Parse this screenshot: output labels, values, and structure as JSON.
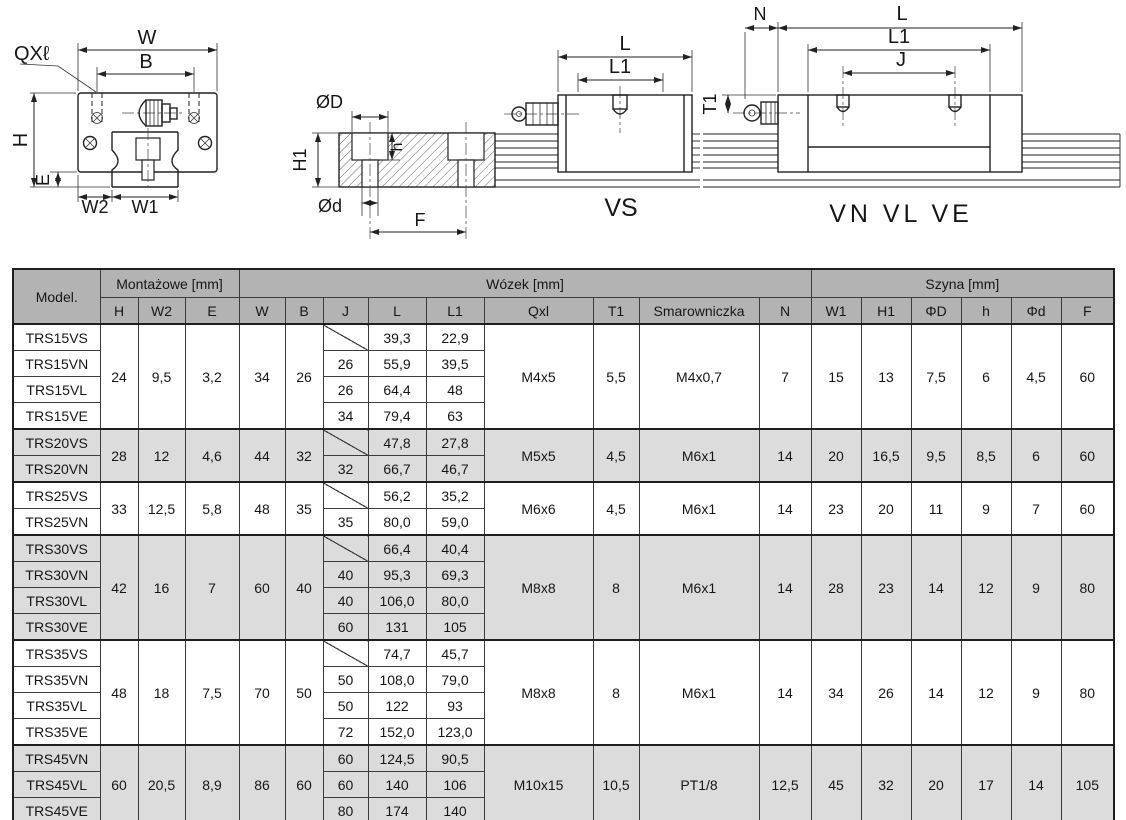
{
  "colors": {
    "header_bg": "#b3b3b3",
    "shaded_row_bg": "#dcdcdc",
    "border": "#3c3c3c",
    "text": "#161616"
  },
  "drawings": {
    "cross_section": {
      "qxl": "QXℓ",
      "w": "W",
      "b": "B",
      "h": "H",
      "e": "E",
      "w2": "W2",
      "w1": "W1"
    },
    "rail_section": {
      "od": "ØD",
      "h1": "H1",
      "h": "h",
      "od_small": "Ød",
      "f": "F"
    },
    "vs_view": {
      "l": "L",
      "l1": "L1",
      "caption": "VS"
    },
    "vn_view": {
      "n": "N",
      "l": "L",
      "l1": "L1",
      "j": "J",
      "t1": "T1",
      "caption": "VN VL VE"
    }
  },
  "table": {
    "corner_label": "Model.",
    "group_headers": [
      {
        "label": "Montażowe [mm]",
        "span": 3
      },
      {
        "label": "Wózek [mm]",
        "span": 9
      },
      {
        "label": "Szyna [mm]",
        "span": 6
      }
    ],
    "columns": [
      "H",
      "W2",
      "E",
      "W",
      "B",
      "J",
      "L",
      "L1",
      "Qxl",
      "T1",
      "Smarowniczka",
      "N",
      "W1",
      "H1",
      "ΦD",
      "h",
      "Φd",
      "F"
    ],
    "groups": [
      {
        "shaded": false,
        "shared": {
          "H": "24",
          "W2": "9,5",
          "E": "3,2",
          "W": "34",
          "B": "26",
          "Qxl": "M4x5",
          "T1": "5,5",
          "Smarowniczka": "M4x0,7",
          "N": "7",
          "W1": "15",
          "H1": "13",
          "ΦD": "7,5",
          "h": "6",
          "Φd": "4,5",
          "F": "60"
        },
        "rows": [
          {
            "model": "TRS15VS",
            "J": null,
            "L": "39,3",
            "L1": "22,9"
          },
          {
            "model": "TRS15VN",
            "J": "26",
            "L": "55,9",
            "L1": "39,5"
          },
          {
            "model": "TRS15VL",
            "J": "26",
            "L": "64,4",
            "L1": "48"
          },
          {
            "model": "TRS15VE",
            "J": "34",
            "L": "79,4",
            "L1": "63"
          }
        ]
      },
      {
        "shaded": true,
        "shared": {
          "H": "28",
          "W2": "12",
          "E": "4,6",
          "W": "44",
          "B": "32",
          "Qxl": "M5x5",
          "T1": "4,5",
          "Smarowniczka": "M6x1",
          "N": "14",
          "W1": "20",
          "H1": "16,5",
          "ΦD": "9,5",
          "h": "8,5",
          "Φd": "6",
          "F": "60"
        },
        "rows": [
          {
            "model": "TRS20VS",
            "J": null,
            "L": "47,8",
            "L1": "27,8"
          },
          {
            "model": "TRS20VN",
            "J": "32",
            "L": "66,7",
            "L1": "46,7"
          }
        ]
      },
      {
        "shaded": false,
        "shared": {
          "H": "33",
          "W2": "12,5",
          "E": "5,8",
          "W": "48",
          "B": "35",
          "Qxl": "M6x6",
          "T1": "4,5",
          "Smarowniczka": "M6x1",
          "N": "14",
          "W1": "23",
          "H1": "20",
          "ΦD": "11",
          "h": "9",
          "Φd": "7",
          "F": "60"
        },
        "rows": [
          {
            "model": "TRS25VS",
            "J": null,
            "L": "56,2",
            "L1": "35,2"
          },
          {
            "model": "TRS25VN",
            "J": "35",
            "L": "80,0",
            "L1": "59,0"
          }
        ]
      },
      {
        "shaded": true,
        "shared": {
          "H": "42",
          "W2": "16",
          "E": "7",
          "W": "60",
          "B": "40",
          "Qxl": "M8x8",
          "T1": "8",
          "Smarowniczka": "M6x1",
          "N": "14",
          "W1": "28",
          "H1": "23",
          "ΦD": "14",
          "h": "12",
          "Φd": "9",
          "F": "80"
        },
        "rows": [
          {
            "model": "TRS30VS",
            "J": null,
            "L": "66,4",
            "L1": "40,4"
          },
          {
            "model": "TRS30VN",
            "J": "40",
            "L": "95,3",
            "L1": "69,3"
          },
          {
            "model": "TRS30VL",
            "J": "40",
            "L": "106,0",
            "L1": "80,0"
          },
          {
            "model": "TRS30VE",
            "J": "60",
            "L": "131",
            "L1": "105"
          }
        ]
      },
      {
        "shaded": false,
        "shared": {
          "H": "48",
          "W2": "18",
          "E": "7,5",
          "W": "70",
          "B": "50",
          "Qxl": "M8x8",
          "T1": "8",
          "Smarowniczka": "M6x1",
          "N": "14",
          "W1": "34",
          "H1": "26",
          "ΦD": "14",
          "h": "12",
          "Φd": "9",
          "F": "80"
        },
        "rows": [
          {
            "model": "TRS35VS",
            "J": null,
            "L": "74,7",
            "L1": "45,7"
          },
          {
            "model": "TRS35VN",
            "J": "50",
            "L": "108,0",
            "L1": "79,0"
          },
          {
            "model": "TRS35VL",
            "J": "50",
            "L": "122",
            "L1": "93"
          },
          {
            "model": "TRS35VE",
            "J": "72",
            "L": "152,0",
            "L1": "123,0"
          }
        ]
      },
      {
        "shaded": true,
        "shared": {
          "H": "60",
          "W2": "20,5",
          "E": "8,9",
          "W": "86",
          "B": "60",
          "Qxl": "M10x15",
          "T1": "10,5",
          "Smarowniczka": "PT1/8",
          "N": "12,5",
          "W1": "45",
          "H1": "32",
          "ΦD": "20",
          "h": "17",
          "Φd": "14",
          "F": "105"
        },
        "rows": [
          {
            "model": "TRS45VN",
            "J": "60",
            "L": "124,5",
            "L1": "90,5"
          },
          {
            "model": "TRS45VL",
            "J": "60",
            "L": "140",
            "L1": "106"
          },
          {
            "model": "TRS45VE",
            "J": "80",
            "L": "174",
            "L1": "140"
          }
        ]
      }
    ]
  }
}
